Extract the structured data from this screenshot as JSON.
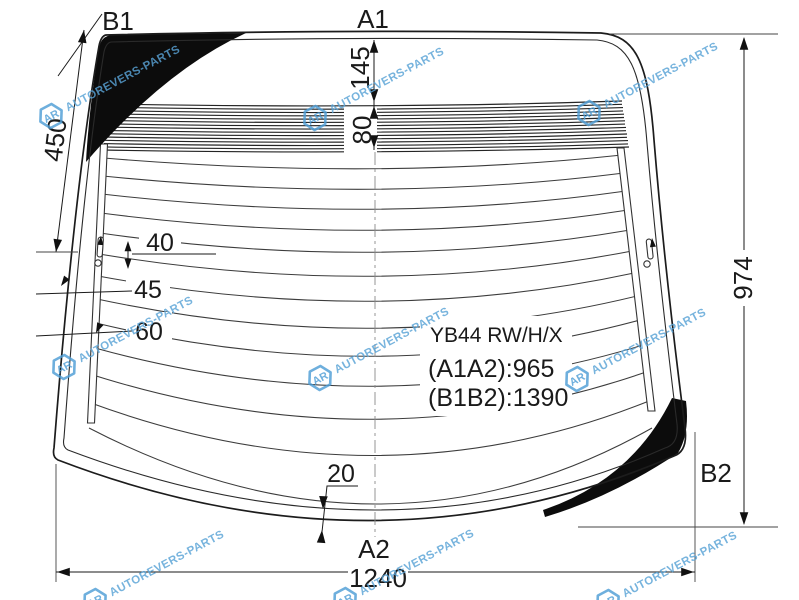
{
  "page": {
    "background": "#ffffff",
    "line_color": "#1a1a1a",
    "watermark_color": "#59a3d6"
  },
  "part_label": {
    "code": "YB44 RW/H/X",
    "a1a2": "(A1A2):965",
    "b1b2": "(B1B2):1390"
  },
  "points": {
    "b1": "B1",
    "a1": "A1",
    "a2": "A2",
    "b2": "B2"
  },
  "dimensions": {
    "left_edge": "450",
    "top_to_band": "145",
    "band_height": "80",
    "gap_top": "40",
    "gap_mid": "45",
    "gap_low": "60",
    "right_height": "974",
    "bottom_gap": "20",
    "bottom_width": "1240"
  },
  "watermark": {
    "text": "AUTOREVERS-PARTS",
    "logo_initials": "AR"
  }
}
